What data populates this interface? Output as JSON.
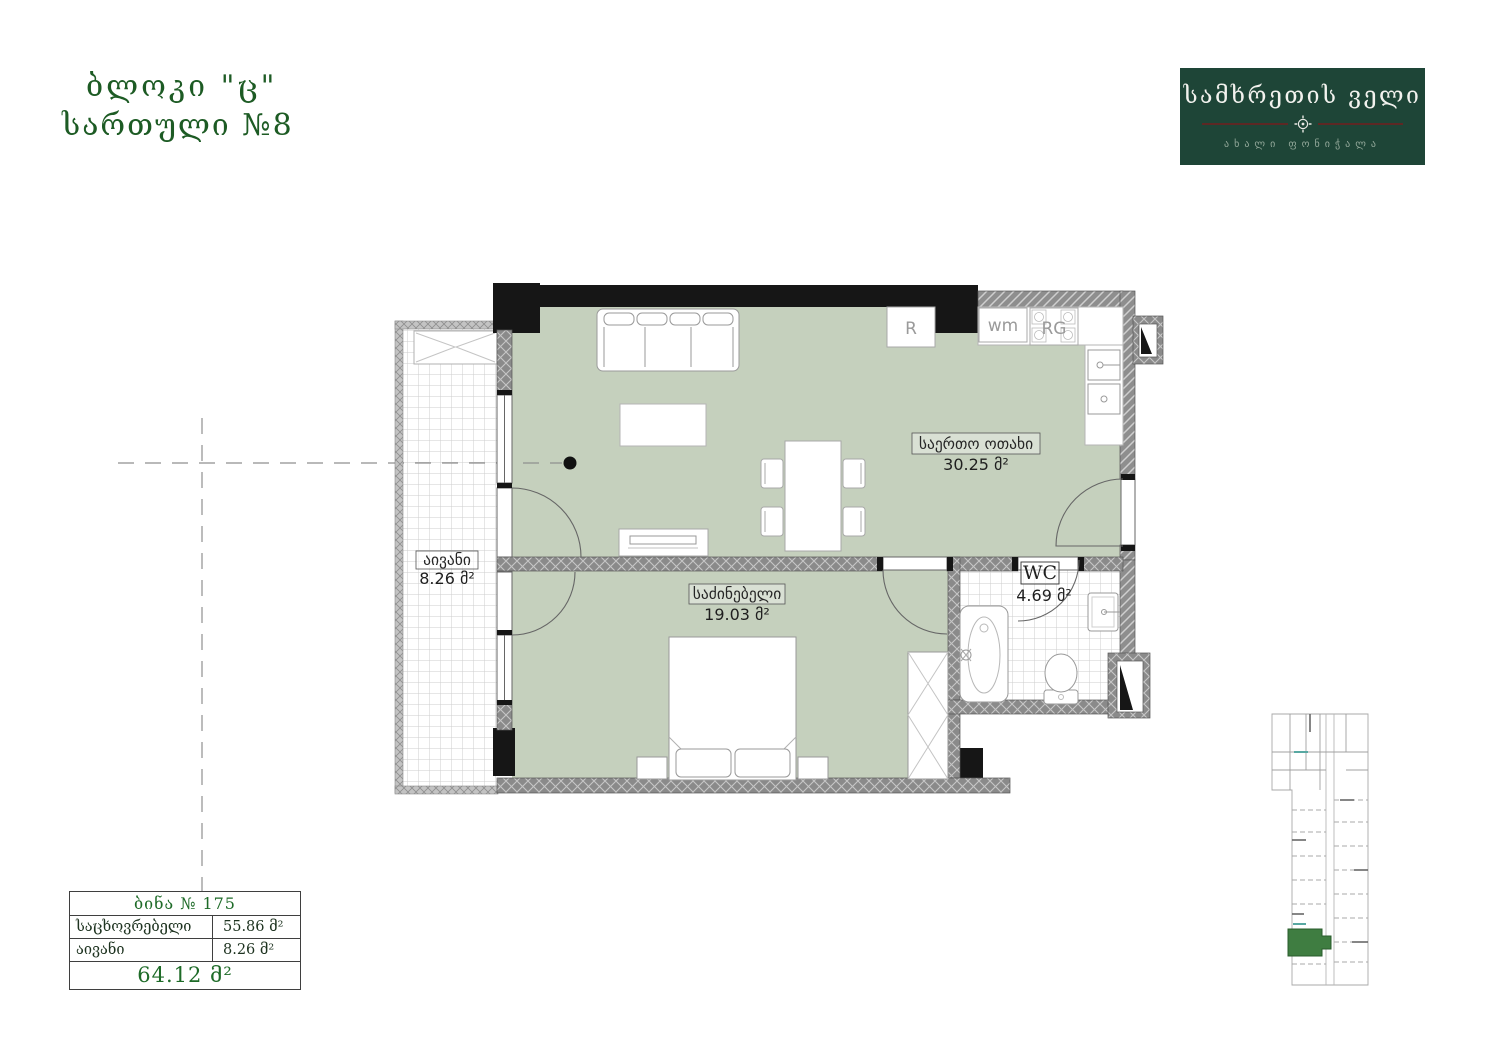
{
  "header": {
    "block": "ბლოკი \"ც\"",
    "floor": "სართული №8"
  },
  "logo": {
    "name": "სამხრეთის ველი",
    "tagline": "ახალი ფონიჭალა"
  },
  "plan": {
    "living_room": {
      "label": "საერთო ოთახი",
      "area": "30.25 მ²"
    },
    "bedroom": {
      "label": "საძინებელი",
      "area": "19.03 მ²"
    },
    "balcony": {
      "label": "აივანი",
      "area": "8.26 მ²"
    },
    "wc": {
      "label": "WC",
      "area": "4.69 მ²"
    },
    "kitchen": {
      "fridge": "R",
      "washing_machine": "wm",
      "range": "RG"
    }
  },
  "summary": {
    "apartment": "ბინა № 175",
    "rows": [
      {
        "label": "საცხოვრებელი",
        "value": "55.86 მ²"
      },
      {
        "label": "აივანი",
        "value": "8.26 მ²"
      }
    ],
    "total": "64.12 მ²"
  },
  "colors": {
    "accent_green": "#1d5b24",
    "logo_background": "#1e4537",
    "room_fill": "#c5d0bd",
    "site_highlight": "#3f7d41",
    "wall_dark": "#161616"
  }
}
